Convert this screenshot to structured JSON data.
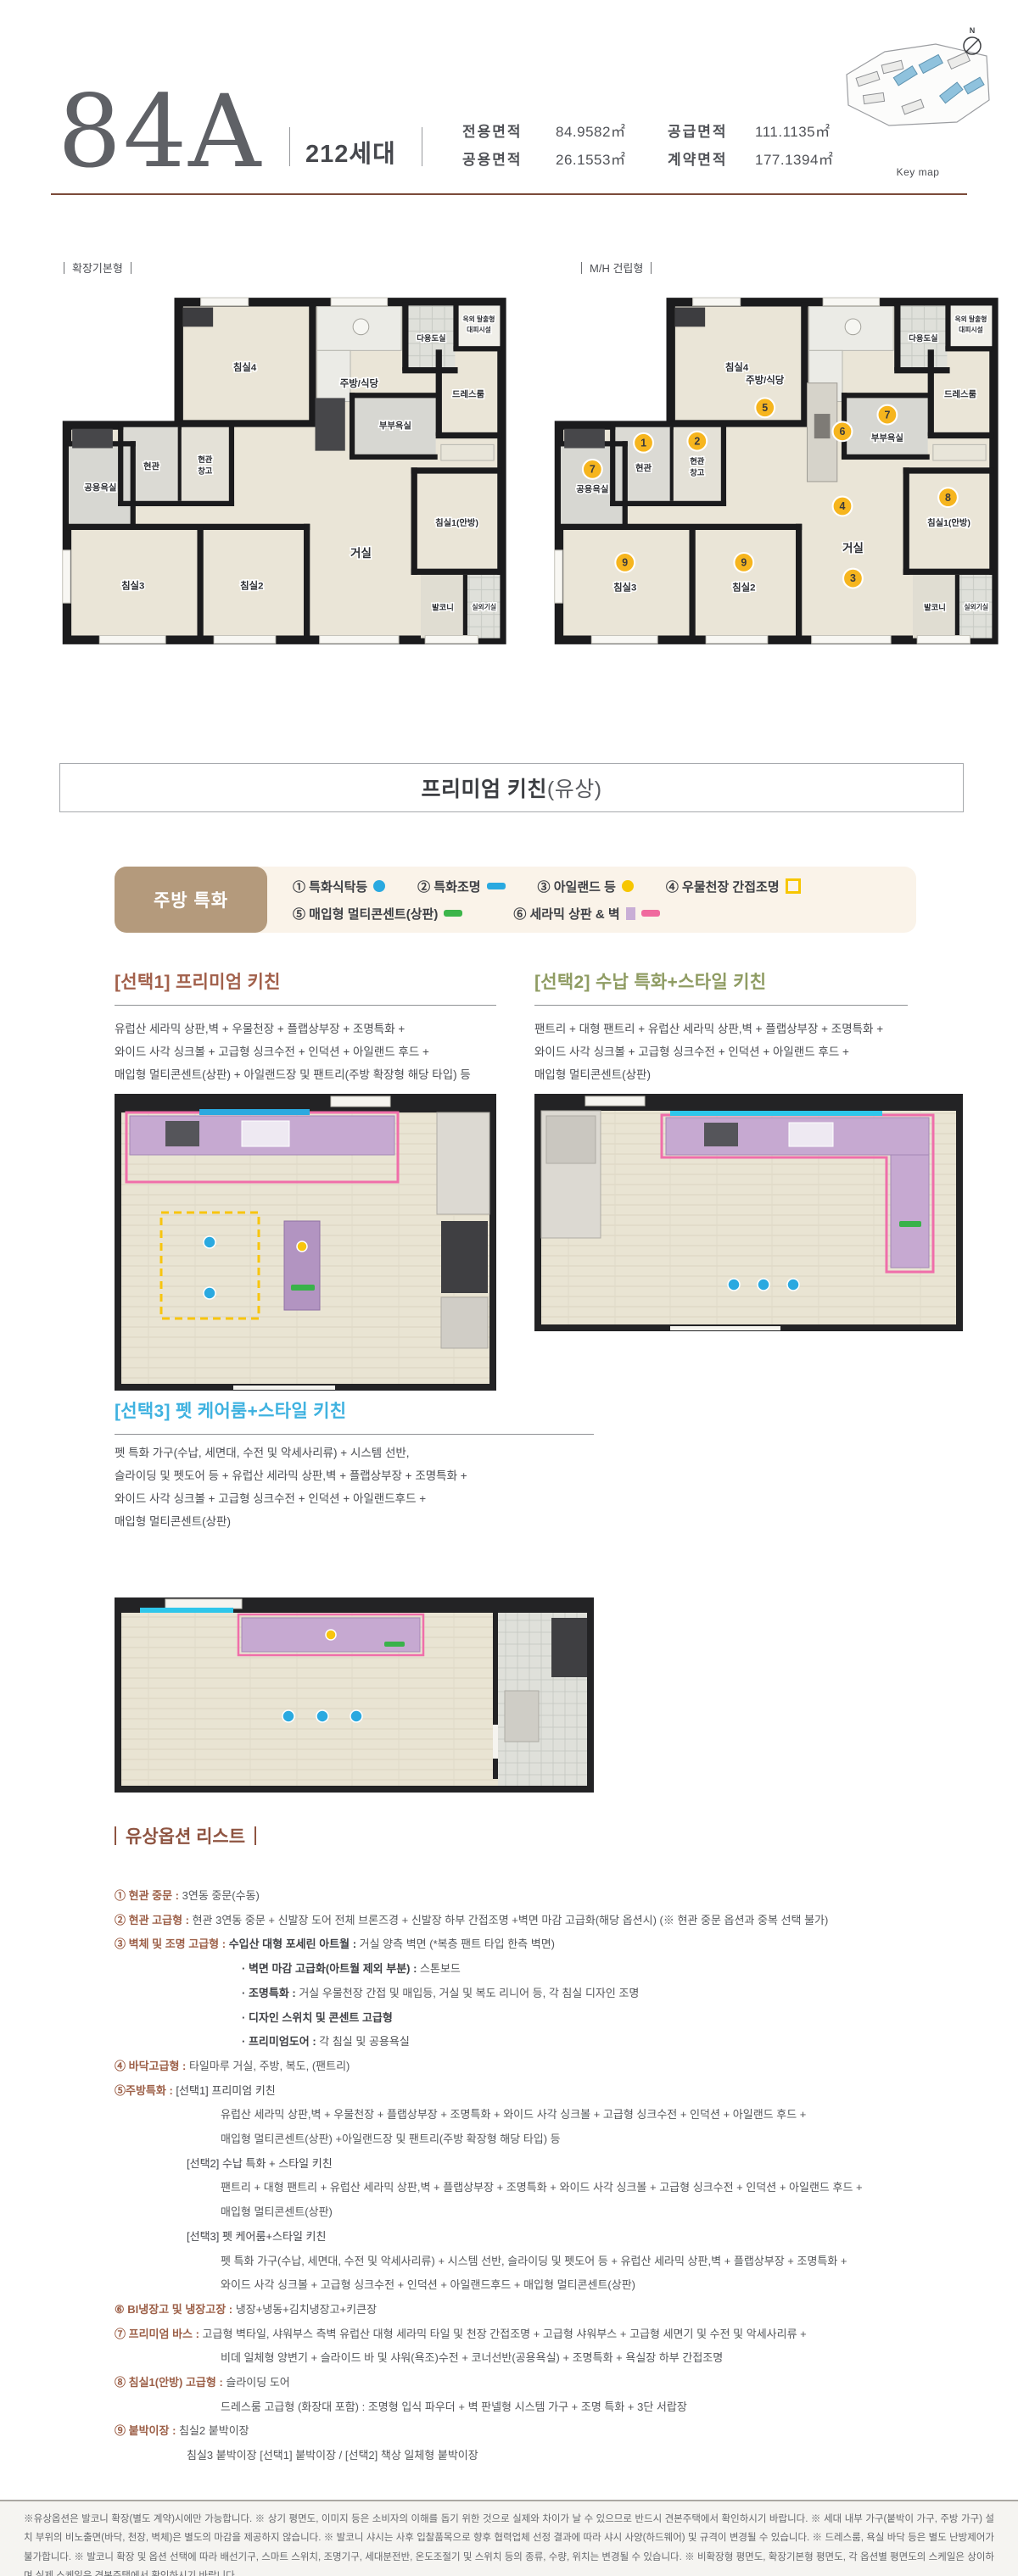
{
  "header": {
    "unit_type": "84A",
    "household_count": "212세대",
    "areas": [
      {
        "label": "전용면적",
        "value": "84.9582㎡"
      },
      {
        "label": "공용면적",
        "value": "26.1553㎡"
      },
      {
        "label": "공급면적",
        "value": "111.1135㎡"
      },
      {
        "label": "계약면적",
        "value": "177.1394㎡"
      }
    ],
    "keymap_label": "Key map",
    "compass_label": "N"
  },
  "floorplans": {
    "left": {
      "type_label": "확장기본형"
    },
    "right": {
      "type_label": "M/H 건립형",
      "badges": [
        "1",
        "2",
        "5",
        "6",
        "7",
        "7",
        "4",
        "3",
        "8",
        "9",
        "9"
      ]
    },
    "rooms": {
      "bed4": "침실4",
      "kitchen": "주방/식당",
      "utility": "다용도실",
      "escape1": "옥외 탈출형",
      "escape2": "대피시설",
      "dress": "드레스룸",
      "entry": "현관",
      "storage1": "현관",
      "storage2": "창고",
      "mbath": "부부욕실",
      "cbath": "공용욕실",
      "living": "거실",
      "bed1": "침실1(안방)",
      "bed3": "침실3",
      "bed2": "침실2",
      "balcony": "발코니",
      "acunit": "실외기실"
    }
  },
  "premium_kitchen": {
    "title": "프리미엄 키친",
    "title_suffix": "(유상)",
    "legend": {
      "tag": "주방 특화",
      "items": [
        "① 특화식탁등",
        "② 특화조명",
        "③ 아일랜드 등",
        "④ 우물천장 간접조명",
        "⑤ 매입형 멀티콘센트(상판)",
        "⑥ 세라믹 상판 & 벽"
      ]
    },
    "options": [
      {
        "title": "[선택1] 프리미엄 키친",
        "desc": [
          "유럽산 세라믹 상판,벽 + 우물천장 + 플랩상부장 + 조명특화 +",
          "와이드 사각 싱크볼 + 고급형 싱크수전 + 인덕션 + 아일랜드 후드 +",
          "매입형 멀티콘센트(상판) + 아일랜드장 및 팬트리(주방 확장형 해당 타입) 등"
        ]
      },
      {
        "title": "[선택2] 수납 특화+스타일 키친",
        "desc": [
          "팬트리 + 대형 팬트리 + 유럽산 세라믹 상판,벽 + 플랩상부장 + 조명특화 +",
          "와이드 사각 싱크볼 + 고급형 싱크수전 + 인덕션 + 아일랜드 후드 +",
          "매입형 멀티콘센트(상판)"
        ]
      },
      {
        "title": "[선택3] 펫 케어룸+스타일 키친",
        "desc": [
          "펫 특화 가구(수납, 세면대, 수전 및 악세사리류) + 시스템 선반,",
          "슬라이딩 및 펫도어 등 + 유럽산 세라믹 상판,벽 + 플랩상부장 + 조명특화 +",
          "와이드 사각 싱크볼 + 고급형 싱크수전 + 인덕션 + 아일랜드후드 +",
          "매입형 멀티콘센트(상판)"
        ]
      }
    ]
  },
  "paid_options": {
    "title": "유상옵션 리스트",
    "items": [
      {
        "cls": "l0",
        "h": "① 현관 중문 : ",
        "b": "3연동 중문(수동)"
      },
      {
        "cls": "l0",
        "h": "② 현관 고급형 : ",
        "b": "현관 3연동 중문 + 신발장 도어 전체 브론즈경 + 신발장 하부 간접조명 +벽면 마감 고급화(해당 옵션시) (※ 현관 중문 옵션과 중복 선택 불가)"
      },
      {
        "cls": "l0",
        "h": "③ 벽체 및 조명 고급형 : ",
        "m": "수입산 대형 포세린 아트월 : ",
        "b": "거실 양측 벽면 (*복층 팬트 타입 한측 벽면)"
      },
      {
        "cls": "sub",
        "h": "· 벽면 마감 고급화(아트월 제외 부분) : ",
        "b": "스톤보드"
      },
      {
        "cls": "sub",
        "h": "· 조명특화 : ",
        "b": "거실 우물천장 간접 및 매입등, 거실 및 복도 리니어 등, 각 침실 디자인 조명"
      },
      {
        "cls": "sub",
        "h": "· 디자인 스위치 및 콘센트 고급형"
      },
      {
        "cls": "sub",
        "h": "· 프리미엄도어 : ",
        "b": "각 침실 및 공용욕실"
      },
      {
        "cls": "l0",
        "h": "④ 바닥고급형 : ",
        "b": "타일마루 거실, 주방, 복도, (팬트리)"
      },
      {
        "cls": "l0",
        "h": "⑤주방특화 : ",
        "t": "[선택1] 프리미엄 키친"
      },
      {
        "cls": "desc",
        "b": "유럽산 세라믹 상판,벽 + 우물천장 + 플랩상부장 + 조명특화 + 와이드 사각 싱크볼 + 고급형 싱크수전 + 인덕션 + 아일랜드 후드 +"
      },
      {
        "cls": "desc",
        "b": "매입형 멀티콘센트(상판) +아일랜드장 및 팬트리(주방 확장형 해당 타입) 등"
      },
      {
        "cls": "sel",
        "t": "[선택2] 수납 특화 + 스타일 키친"
      },
      {
        "cls": "desc",
        "b": "팬트리 + 대형 팬트리 + 유럽산 세라믹 상판,벽 + 플랩상부장 + 조명특화 + 와이드 사각 싱크볼 + 고급형 싱크수전 + 인덕션 + 아일랜드 후드 +"
      },
      {
        "cls": "desc",
        "b": "매입형 멀티콘센트(상판)"
      },
      {
        "cls": "sel",
        "t": "[선택3] 펫 케어룸+스타일 키친"
      },
      {
        "cls": "desc",
        "b": "펫 특화 가구(수납, 세면대, 수전 및 악세사리류) + 시스템 선반, 슬라이딩 및 펫도어 등 + 유럽산 세라믹 상판,벽 + 플랩상부장 + 조명특화 +"
      },
      {
        "cls": "desc",
        "b": "와이드 사각 싱크볼 + 고급형 싱크수전 + 인덕션 + 아일랜드후드 + 매입형 멀티콘센트(상판)"
      },
      {
        "cls": "l0",
        "h": "⑥ BI냉장고 및 냉장고장 : ",
        "b": "냉장+냉동+김치냉장고+키큰장"
      },
      {
        "cls": "l0",
        "h": "⑦ 프리미엄 바스 : ",
        "b": "고급형 벽타일, 샤워부스 측벽 유럽산 대형 세라믹 타일 및 천장 간접조명 + 고급형 샤워부스 + 고급형 세면기 및 수전 및 악세사리류 +"
      },
      {
        "cls": "desc",
        "b": "비데 일체형 양변기 + 슬라이드 바 및 샤워(욕조)수전 + 코너선반(공용욕실) + 조명특화 + 욕실장 하부 간접조명"
      },
      {
        "cls": "l0",
        "h": "⑧ 침실1(안방) 고급형 : ",
        "b": "슬라이딩 도어"
      },
      {
        "cls": "desc",
        "b": "드레스룸 고급형 (화장대 포함) : 조명형 입식 파우더 + 벽 판넬형 시스템 가구 + 조명 특화 + 3단 서랍장"
      },
      {
        "cls": "l0",
        "h": "⑨ 붙박이장 : ",
        "b": "침실2 붙박이장"
      },
      {
        "cls": "sel",
        "b": "침실3 붙박이장 [선택1] 붙박이장 / [선택2] 책상 일체형 붙박이장"
      }
    ]
  },
  "footer": {
    "disclaimer": "※유상옵션은 발코니 확장(별도 계약)시에만 가능합니다. ※ 상기 평면도, 이미지 등은 소비자의 이해를 돕기 위한 것으로 실제와 차이가 날 수 있으므로 반드시 견본주택에서 확인하시기 바랍니다. ※ 세대 내부 가구(붙박이 가구, 주방 가구) 설치 부위의 비노출면(바닥, 천장, 벽체)은 별도의 마감을 제공하지 않습니다. ※ 발코니 샤시는 사후 입찰품목으로 향후 협력업체 선정 결과에 따라 샤시 사양(하드웨어) 및 규격이 변경될 수 있습니다. ※ 드레스룸, 욕실 바닥 등은 별도 난방제어가 불가합니다. ※ 발코니 확장 및 옵션 선택에 따라 배선기구, 스마트 스위치, 조명기구, 세대분전반, 온도조절기 및 스위치 등의 종류, 수량, 위치는 변경될 수 있습니다. ※ 비확장형 평면도, 확장기본형 평면도, 각 옵션별 평면도의 스케일은 상이하며 실제 스케일은 견본주택에서 확인하시기 바랍니다."
  },
  "colors": {
    "accent_brown": "#8e5441",
    "select1": "#a2604b",
    "select2": "#8f9c63",
    "select3": "#3fb2e0",
    "legend_tag_bg": "#b49a7c",
    "badge_yellow": "#f6b51e",
    "highlight_pink": "#f06eaa",
    "highlight_purple": "#c6a9d1",
    "highlight_blue": "#2aa9e0",
    "highlight_green": "#39b24a",
    "highlight_yellow": "#f8c50e"
  }
}
